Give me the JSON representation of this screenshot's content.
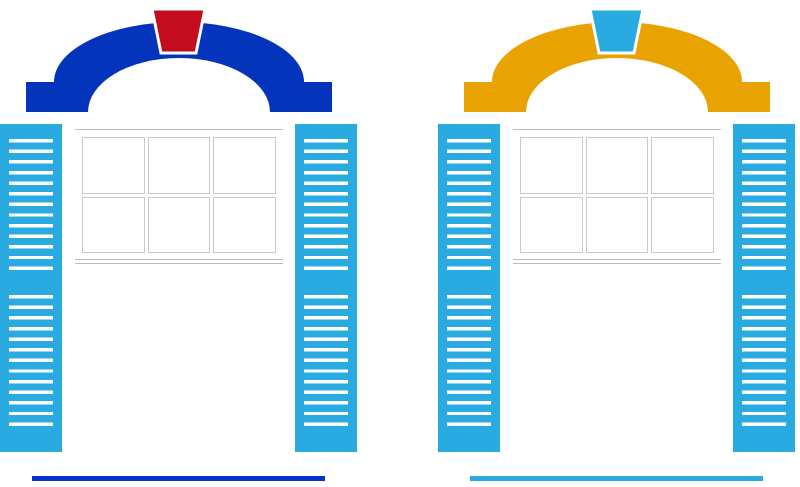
{
  "canvas": {
    "width": 800,
    "height": 487,
    "background": "#ffffff"
  },
  "windows": [
    {
      "side": "left",
      "arch_color": "#0434bb",
      "keystone_color": "#c30d1e",
      "shutter_color": "#29abe2",
      "slat_color": "#ffffff",
      "window_color": "#ffffff",
      "pane_border_color": "#c9c9c9",
      "frame_line_color": "#bdbdbd",
      "underline_color": "#0433cb",
      "pane_rows": 2,
      "pane_cols": 3
    },
    {
      "side": "right",
      "arch_color": "#e8a303",
      "keystone_color": "#29abe2",
      "shutter_color": "#29abe2",
      "slat_color": "#ffffff",
      "window_color": "#ffffff",
      "pane_border_color": "#c9c9c9",
      "frame_line_color": "#bdbdbd",
      "underline_color": "#29abe2",
      "pane_rows": 2,
      "pane_cols": 3
    }
  ]
}
